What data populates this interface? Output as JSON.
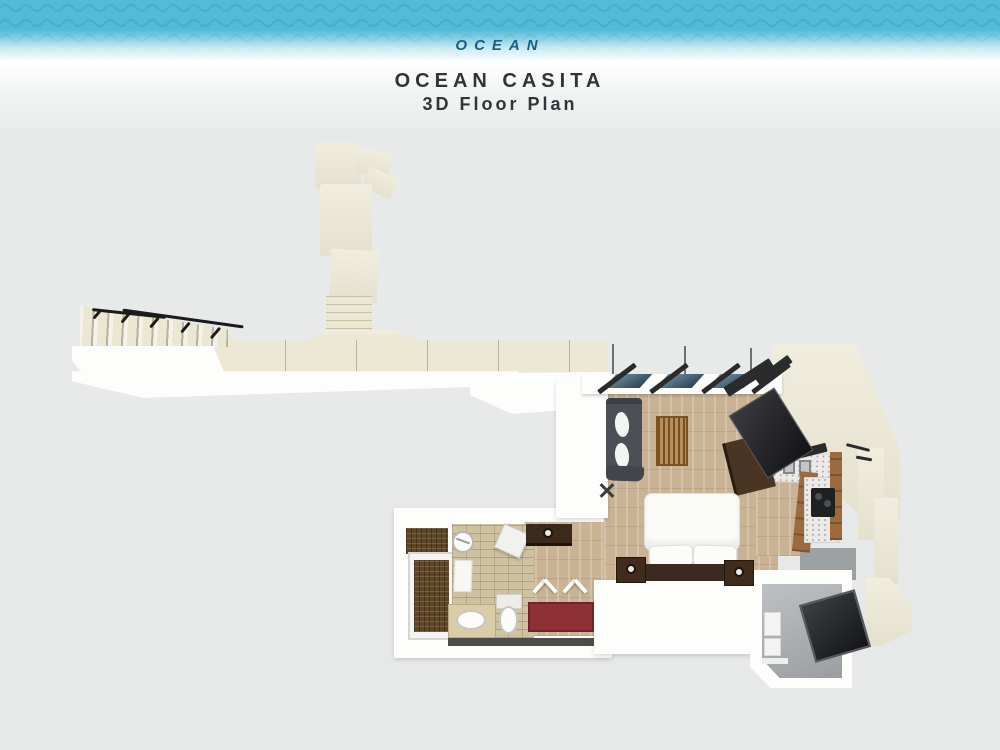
{
  "header": {
    "band_label": "OCEAN",
    "title": "OCEAN CASITA",
    "subtitle": "3D Floor Plan"
  },
  "palette": {
    "band_blue": "#57bfda",
    "wave_blue": "#41a8c6",
    "band_label_color": "#1a5f80",
    "title_color": "#313438",
    "background_gray": "#e7e9e9",
    "deck_cream": "#ebe7d3",
    "wall_white": "#fdfdfc",
    "wood_floor": "#c9b394",
    "bath_tile_tan": "#cfc2a3",
    "shower_tile_brown": "#5e4627",
    "dark_wood_furniture": "#3b2a1d",
    "sofa_gray": "#4c4f55",
    "kitchen_cabinet_wood": "#9c6a3c",
    "rug_red": "#8e3036",
    "utility_floor_gray": "#a8acae",
    "equipment_black": "#2b2c2e",
    "window_glass_blue": "#3e566e"
  },
  "floor_plan": {
    "plan_type": "3D top-down floor plan",
    "areas": [
      "ocean-walkway",
      "walkway-branch",
      "winding-steps",
      "entry-stairs",
      "sun-deck",
      "living-room",
      "kitchen",
      "bedroom",
      "bathroom",
      "shower",
      "closet",
      "hallway",
      "utility-room",
      "side-terrace"
    ],
    "furniture": [
      "stair-handrails",
      "sofa",
      "sofa-cushions",
      "coffee-table",
      "tv-console",
      "wall-tv",
      "corner-shelf",
      "folded-rack",
      "kitchen-counter",
      "double-sink",
      "faucet-shelf",
      "cooktop",
      "cabinets",
      "bed",
      "pillows",
      "nightstand-left",
      "nightstand-right",
      "hall-console",
      "luggage-rack-1",
      "luggage-rack-2",
      "red-rug",
      "ceiling-fan",
      "shower-bench",
      "bath-mat",
      "vanity-sink",
      "toilet",
      "utility-shelves",
      "equipment-panel"
    ]
  }
}
